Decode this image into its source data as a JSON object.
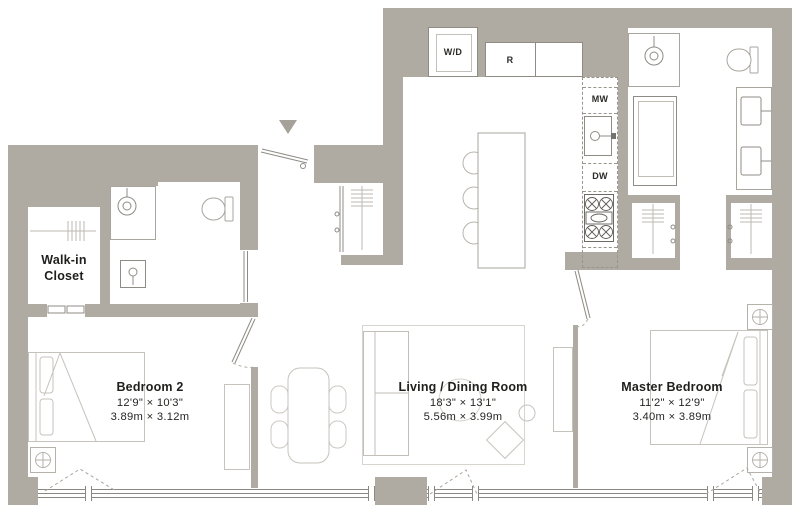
{
  "colors": {
    "wall": "#afaba2",
    "fixture_outline": "#8f8c85",
    "furniture_line": "#c6c3bc",
    "text": "#1f1f1d"
  },
  "rooms": {
    "walk_in_closet": {
      "name_line1": "Walk-in",
      "name_line2": "Closet"
    },
    "bedroom_2": {
      "name": "Bedroom 2",
      "dimensions_imperial": "12'9\" × 10'3\"",
      "dimensions_metric": "3.89m × 3.12m"
    },
    "living_dining": {
      "name": "Living / Dining Room",
      "dimensions_imperial": "18'3\" × 13'1\"",
      "dimensions_metric": "5.56m × 3.99m"
    },
    "master_bedroom": {
      "name": "Master Bedroom",
      "dimensions_imperial": "11'2\" × 12'9\"",
      "dimensions_metric": "3.40m × 3.89m"
    }
  },
  "appliances": {
    "washer_dryer": "W/D",
    "refrigerator": "R",
    "microwave": "MW",
    "dishwasher": "DW"
  }
}
